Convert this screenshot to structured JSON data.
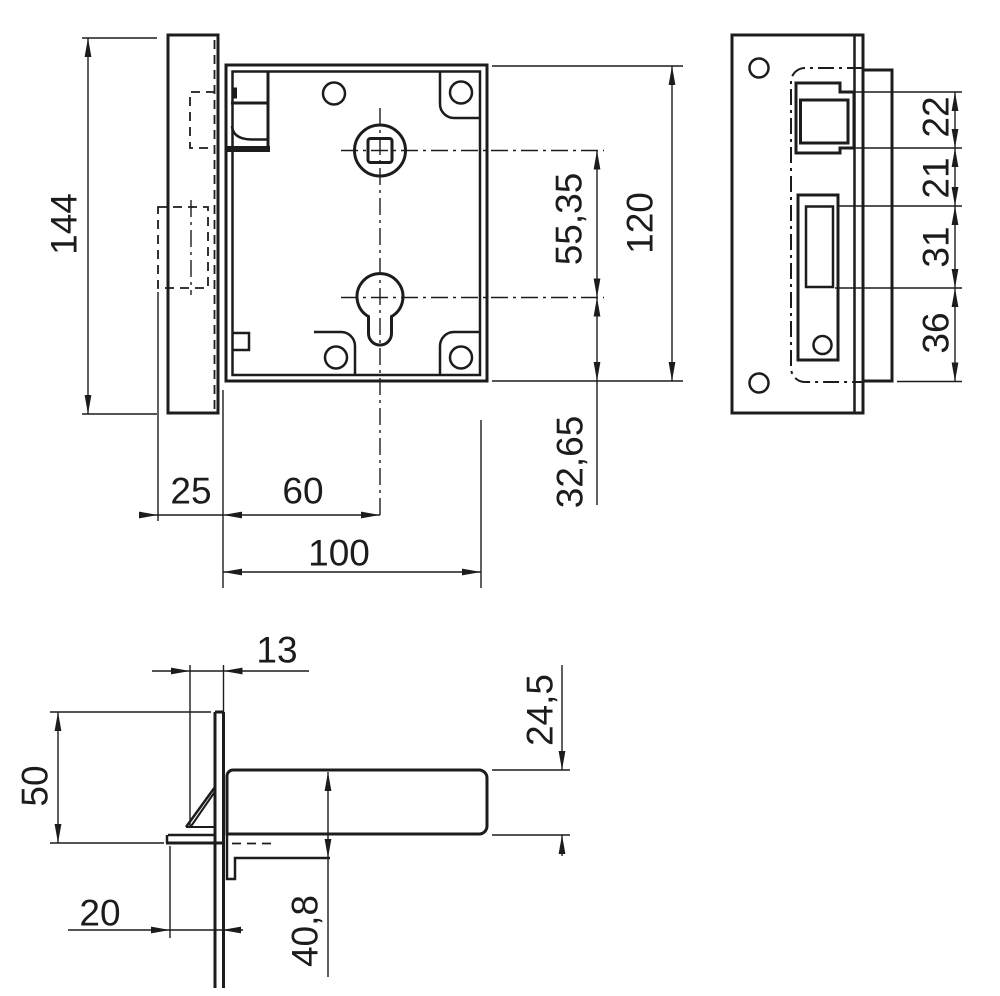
{
  "drawing": {
    "background": "#ffffff",
    "line_color": "#1c1c1c"
  },
  "views": {
    "front": {
      "dims": {
        "plate_height": "144",
        "bolt_throw": "25",
        "backset": "60",
        "case_width": "100",
        "axis_distance": "55,35",
        "case_height": "120",
        "cylinder_offset": "32,65"
      }
    },
    "side": {
      "dims": {
        "latch_pocket": "22",
        "between_pockets": "21",
        "bolt_pocket": "31",
        "lower_section": "36"
      }
    },
    "bottom": {
      "dims": {
        "angle_width": "13",
        "angle_height": "50",
        "foot_length": "20",
        "case_offset": "40,8",
        "case_depth": "24,5"
      }
    }
  }
}
